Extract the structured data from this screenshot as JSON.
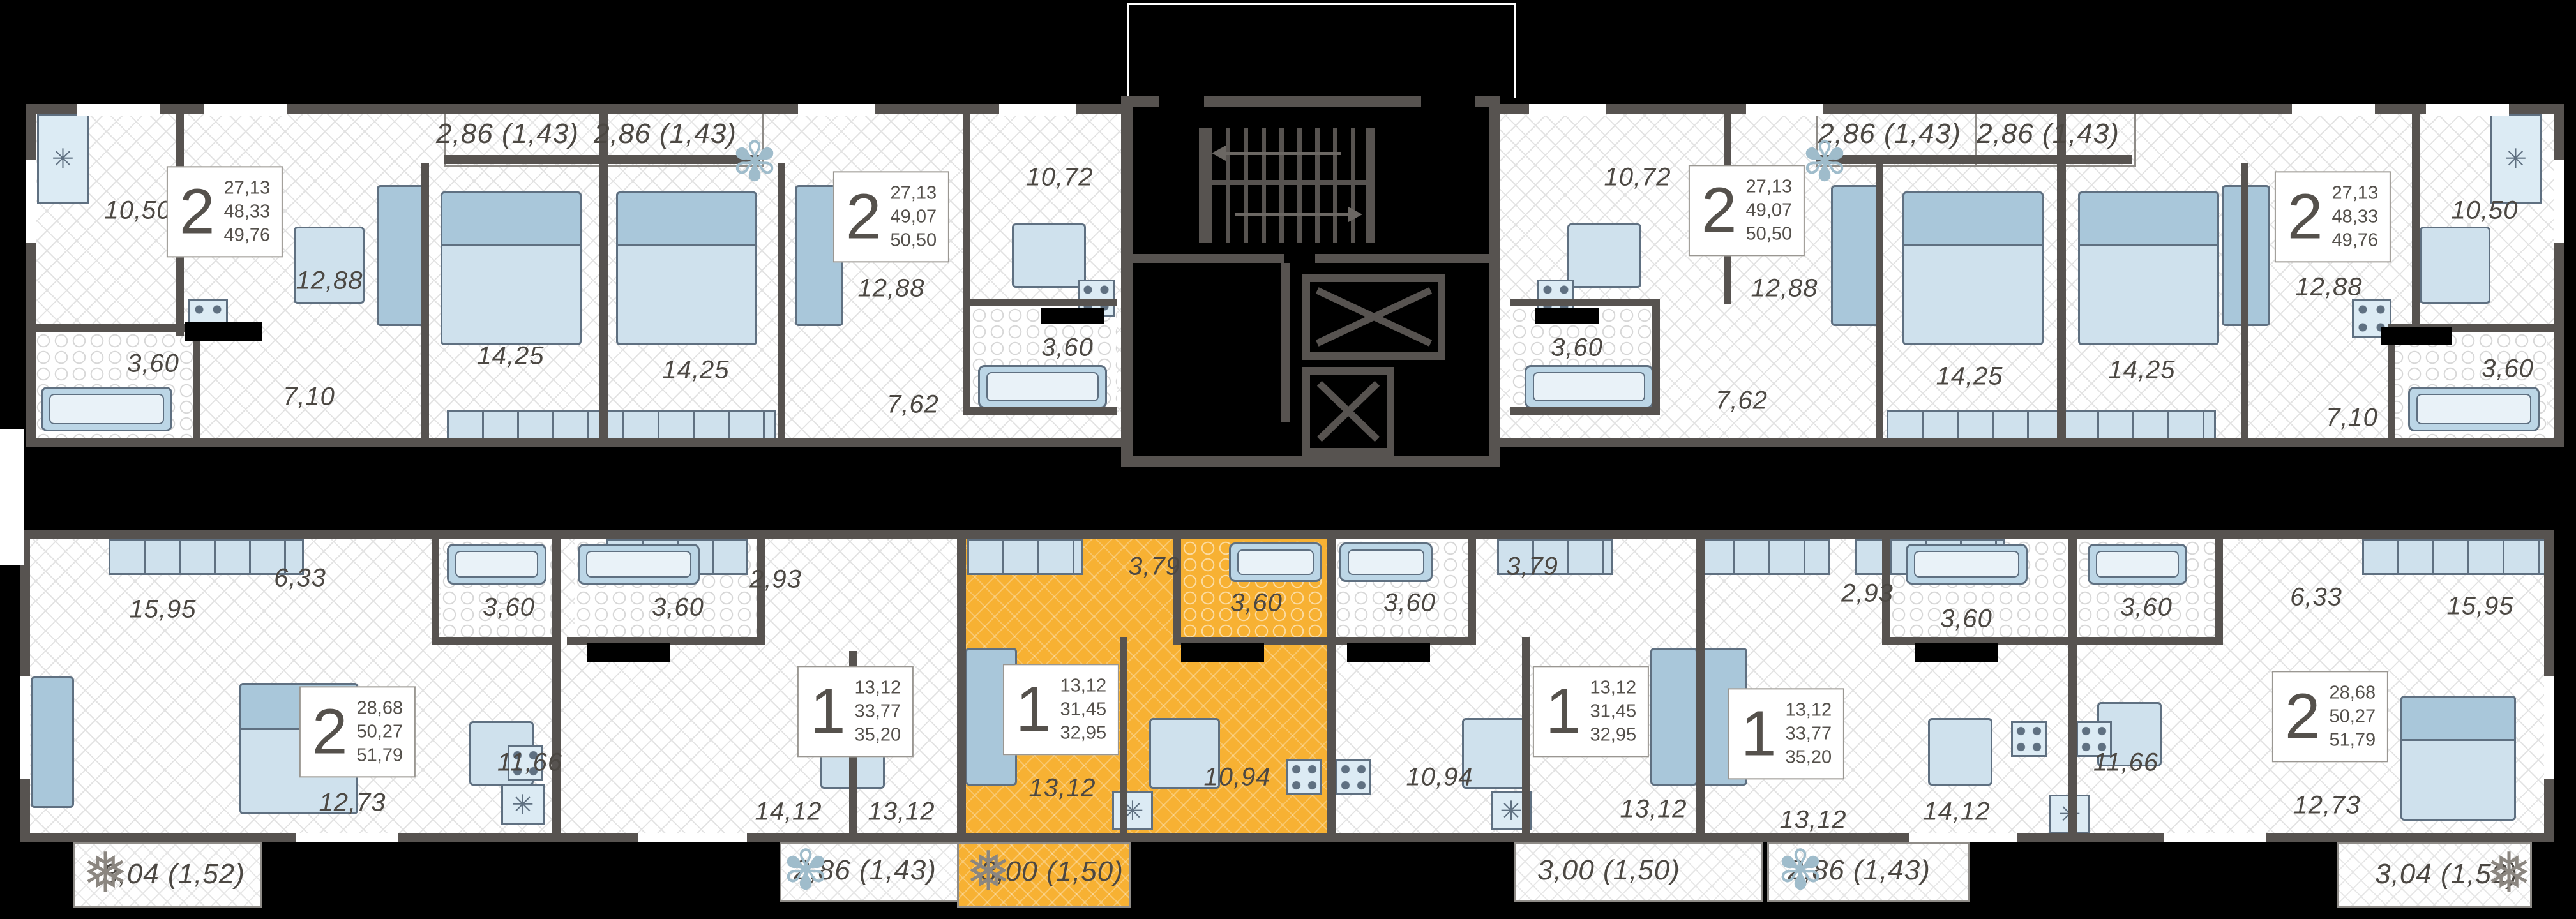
{
  "title": "residential floor plan",
  "colors": {
    "background": "#000000",
    "wall": "#575350",
    "floor": "#ffffff",
    "hatch_line": "#e3e3e3",
    "highlight": "#f7b133",
    "label_text": "#4c4843",
    "furniture_fill": "#cfe1ed",
    "furniture_border": "#5f7081"
  },
  "icons": {
    "fridge": "✳",
    "plant": "✾",
    "snowflake": "❅"
  },
  "apartments": [
    {
      "id": "top-far-left",
      "rooms_count": "2",
      "stat": {
        "living": "27,13",
        "area": "48,33",
        "total": "49,76"
      },
      "labels": [
        "10,50",
        "12,88",
        "3,60",
        "7,10",
        "14,25"
      ]
    },
    {
      "id": "top-left-center",
      "rooms_count": "2",
      "stat": {
        "living": "27,13",
        "area": "49,07",
        "total": "50,50"
      },
      "labels": [
        "14,25",
        "12,88",
        "10,72",
        "3,60",
        "7,62"
      ]
    },
    {
      "id": "top-right-center",
      "rooms_count": "2",
      "stat": {
        "living": "27,13",
        "area": "49,07",
        "total": "50,50"
      },
      "labels": [
        "10,72",
        "12,88",
        "3,60",
        "7,62",
        "14,25"
      ]
    },
    {
      "id": "top-far-right",
      "rooms_count": "2",
      "stat": {
        "living": "27,13",
        "area": "48,33",
        "total": "49,76"
      },
      "labels": [
        "14,25",
        "12,88",
        "10,50",
        "3,60",
        "7,10"
      ]
    },
    {
      "id": "bottom-far-left",
      "rooms_count": "2",
      "stat": {
        "living": "28,68",
        "area": "50,27",
        "total": "51,79"
      },
      "labels": [
        "15,95",
        "6,33",
        "3,60",
        "12,73",
        "11,66"
      ]
    },
    {
      "id": "bottom-left-center",
      "rooms_count": "1",
      "stat": {
        "living": "13,12",
        "area": "33,77",
        "total": "35,20"
      },
      "labels": [
        "3,60",
        "2,93",
        "14,12",
        "13,12"
      ]
    },
    {
      "id": "bottom-center-highlighted",
      "rooms_count": "1",
      "highlighted": true,
      "stat": {
        "living": "13,12",
        "area": "31,45",
        "total": "32,95"
      },
      "labels": [
        "13,12",
        "3,79",
        "3,60",
        "10,94"
      ]
    },
    {
      "id": "bottom-right-center",
      "rooms_count": "1",
      "stat": {
        "living": "13,12",
        "area": "31,45",
        "total": "32,95"
      },
      "labels": [
        "3,79",
        "3,60",
        "10,94",
        "13,12"
      ]
    },
    {
      "id": "bottom-right-1room",
      "rooms_count": "1",
      "stat": {
        "living": "13,12",
        "area": "33,77",
        "total": "35,20"
      },
      "labels": [
        "2,93",
        "3,60",
        "14,12",
        "13,12"
      ]
    },
    {
      "id": "bottom-far-right",
      "rooms_count": "2",
      "stat": {
        "living": "28,68",
        "area": "50,27",
        "total": "51,79"
      },
      "labels": [
        "6,33",
        "15,95",
        "3,60",
        "11,66",
        "12,73"
      ]
    }
  ],
  "balconies": [
    "2,86 (1,43)",
    "2,86 (1,43)",
    "2,86 (1,43)",
    "2,86 (1,43)",
    "3,04 (1,52)",
    "2,86 (1,43)",
    "3,00 (1,50)",
    "3,00 (1,50)",
    "2,86 (1,43)",
    "3,04 (1,52)"
  ]
}
